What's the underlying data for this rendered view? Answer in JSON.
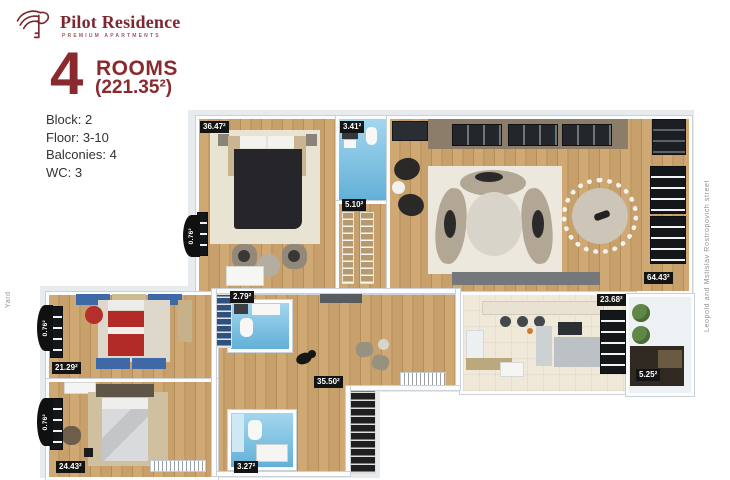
{
  "brand": {
    "name": "Pilot Residence",
    "tagline": "PREMIUM APARTMENTS"
  },
  "title": {
    "number": "4",
    "rooms": "ROOMS",
    "area": "(221.35²)"
  },
  "info": {
    "lines": [
      "Block: 2",
      "Floor: 3-10",
      "Balconies: 4",
      "WC: 3"
    ]
  },
  "context": {
    "street": "Leopold and Mstislav Rostropovich street",
    "yard": "Yard"
  },
  "colors": {
    "brand": "#7d2731",
    "title": "#8b2a2e",
    "label_bg": "#141414",
    "wood_floor": "#c7a06c",
    "bath_blue": "#7cc4e4",
    "kitchen_floor": "#f0e9d9"
  },
  "rooms": {
    "master_bedroom": {
      "label": "36.47²"
    },
    "bathroom_top": {
      "label": "3.41²"
    },
    "wardrobe": {
      "label": "5.10²"
    },
    "living_room": {
      "label": "64.43²"
    },
    "balcony_master": {
      "label": "0.76²"
    },
    "bedroom_2": {
      "label": "21.29²"
    },
    "balcony_bedroom_2": {
      "label": "0.76²"
    },
    "bedroom_3": {
      "label": "24.43²"
    },
    "balcony_bedroom_3": {
      "label": "0.76²"
    },
    "bathroom_mid": {
      "label": "2.79²"
    },
    "hallway": {
      "label": "35.50²"
    },
    "bathroom_lower": {
      "label": "3.27²"
    },
    "kitchen": {
      "label": "23.68²"
    },
    "balcony_kitchen": {
      "label": "5.25²"
    }
  }
}
